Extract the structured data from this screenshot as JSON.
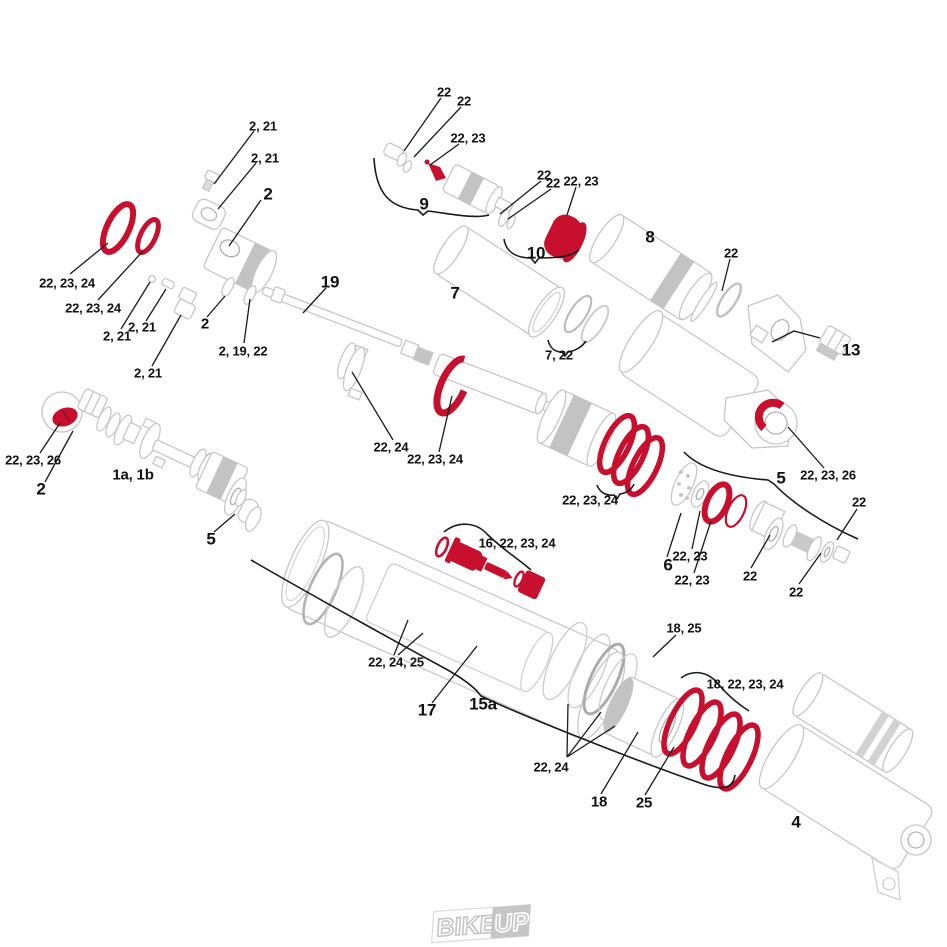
{
  "diagram": {
    "kind": "exploded-parts-diagram",
    "colors": {
      "highlight": "#c8102e",
      "line_art": "#c7c7c7",
      "line_art_dark": "#aeaeae",
      "knurl": "#c3c3c3",
      "label": "#111111",
      "leader": "#1a1a1a",
      "logo": "#c6c6c6"
    },
    "logo": {
      "text": "BIKE!UP",
      "part1": "BIKE!",
      "part2": "UP"
    },
    "callouts": [
      {
        "label": "22",
        "x": 444,
        "y": 92,
        "size": "s"
      },
      {
        "label": "22",
        "x": 464,
        "y": 101,
        "size": "s"
      },
      {
        "label": "22, 23",
        "x": 468,
        "y": 138,
        "size": "s"
      },
      {
        "label": "9",
        "x": 424,
        "y": 204,
        "size": "l"
      },
      {
        "label": "22",
        "x": 544,
        "y": 175,
        "size": "s"
      },
      {
        "label": "22",
        "x": 553,
        "y": 183,
        "size": "s"
      },
      {
        "label": "22, 23",
        "x": 581,
        "y": 181,
        "size": "s"
      },
      {
        "label": "10",
        "x": 536,
        "y": 253,
        "size": "l"
      },
      {
        "label": "8",
        "x": 650,
        "y": 237,
        "size": "l"
      },
      {
        "label": "22",
        "x": 731,
        "y": 253,
        "size": "s"
      },
      {
        "label": "13",
        "x": 851,
        "y": 350,
        "size": "l"
      },
      {
        "label": "7",
        "x": 455,
        "y": 293,
        "size": "l"
      },
      {
        "label": "7, 22",
        "x": 559,
        "y": 355,
        "size": "s"
      },
      {
        "label": "2, 21",
        "x": 263,
        "y": 126,
        "size": "s"
      },
      {
        "label": "2, 21",
        "x": 265,
        "y": 158,
        "size": "s"
      },
      {
        "label": "2",
        "x": 268,
        "y": 194,
        "size": "l"
      },
      {
        "label": "19",
        "x": 330,
        "y": 282,
        "size": "l"
      },
      {
        "label": "22, 23, 24",
        "x": 67,
        "y": 283,
        "size": "s"
      },
      {
        "label": "22, 23, 24",
        "x": 93,
        "y": 308,
        "size": "s"
      },
      {
        "label": "2, 21",
        "x": 117,
        "y": 336,
        "size": "s"
      },
      {
        "label": "2, 21",
        "x": 142,
        "y": 327,
        "size": "s"
      },
      {
        "label": "2, 21",
        "x": 148,
        "y": 373,
        "size": "s"
      },
      {
        "label": "2",
        "x": 205,
        "y": 324,
        "size": "m"
      },
      {
        "label": "2, 19, 22",
        "x": 243,
        "y": 351,
        "size": "s"
      },
      {
        "label": "22, 23, 26",
        "x": 33,
        "y": 460,
        "size": "s"
      },
      {
        "label": "2",
        "x": 41,
        "y": 489,
        "size": "l"
      },
      {
        "label": "1a, 1b",
        "x": 133,
        "y": 475,
        "size": "m"
      },
      {
        "label": "5",
        "x": 211,
        "y": 539,
        "size": "l"
      },
      {
        "label": "22, 24",
        "x": 391,
        "y": 447,
        "size": "s"
      },
      {
        "label": "22, 23, 24",
        "x": 435,
        "y": 459,
        "size": "s"
      },
      {
        "label": "22, 23, 24",
        "x": 590,
        "y": 500,
        "size": "s"
      },
      {
        "label": "5",
        "x": 781,
        "y": 478,
        "size": "l"
      },
      {
        "label": "22, 23, 26",
        "x": 828,
        "y": 475,
        "size": "s"
      },
      {
        "label": "6",
        "x": 668,
        "y": 565,
        "size": "l"
      },
      {
        "label": "22, 23",
        "x": 690,
        "y": 556,
        "size": "s"
      },
      {
        "label": "22, 23",
        "x": 692,
        "y": 580,
        "size": "s"
      },
      {
        "label": "22",
        "x": 750,
        "y": 576,
        "size": "s"
      },
      {
        "label": "22",
        "x": 796,
        "y": 592,
        "size": "s"
      },
      {
        "label": "22",
        "x": 859,
        "y": 502,
        "size": "s"
      },
      {
        "label": "16, 22, 23, 24",
        "x": 517,
        "y": 543,
        "size": "s"
      },
      {
        "label": "22, 24, 25",
        "x": 396,
        "y": 662,
        "size": "s"
      },
      {
        "label": "17",
        "x": 427,
        "y": 710,
        "size": "l"
      },
      {
        "label": "15a",
        "x": 483,
        "y": 704,
        "size": "l"
      },
      {
        "label": "18, 25",
        "x": 684,
        "y": 628,
        "size": "s"
      },
      {
        "label": "18, 22, 23, 24",
        "x": 745,
        "y": 684,
        "size": "s"
      },
      {
        "label": "22, 24",
        "x": 551,
        "y": 767,
        "size": "s"
      },
      {
        "label": "18",
        "x": 599,
        "y": 802,
        "size": "m"
      },
      {
        "label": "25",
        "x": 644,
        "y": 803,
        "size": "m"
      },
      {
        "label": "4",
        "x": 796,
        "y": 822,
        "size": "l"
      }
    ]
  }
}
